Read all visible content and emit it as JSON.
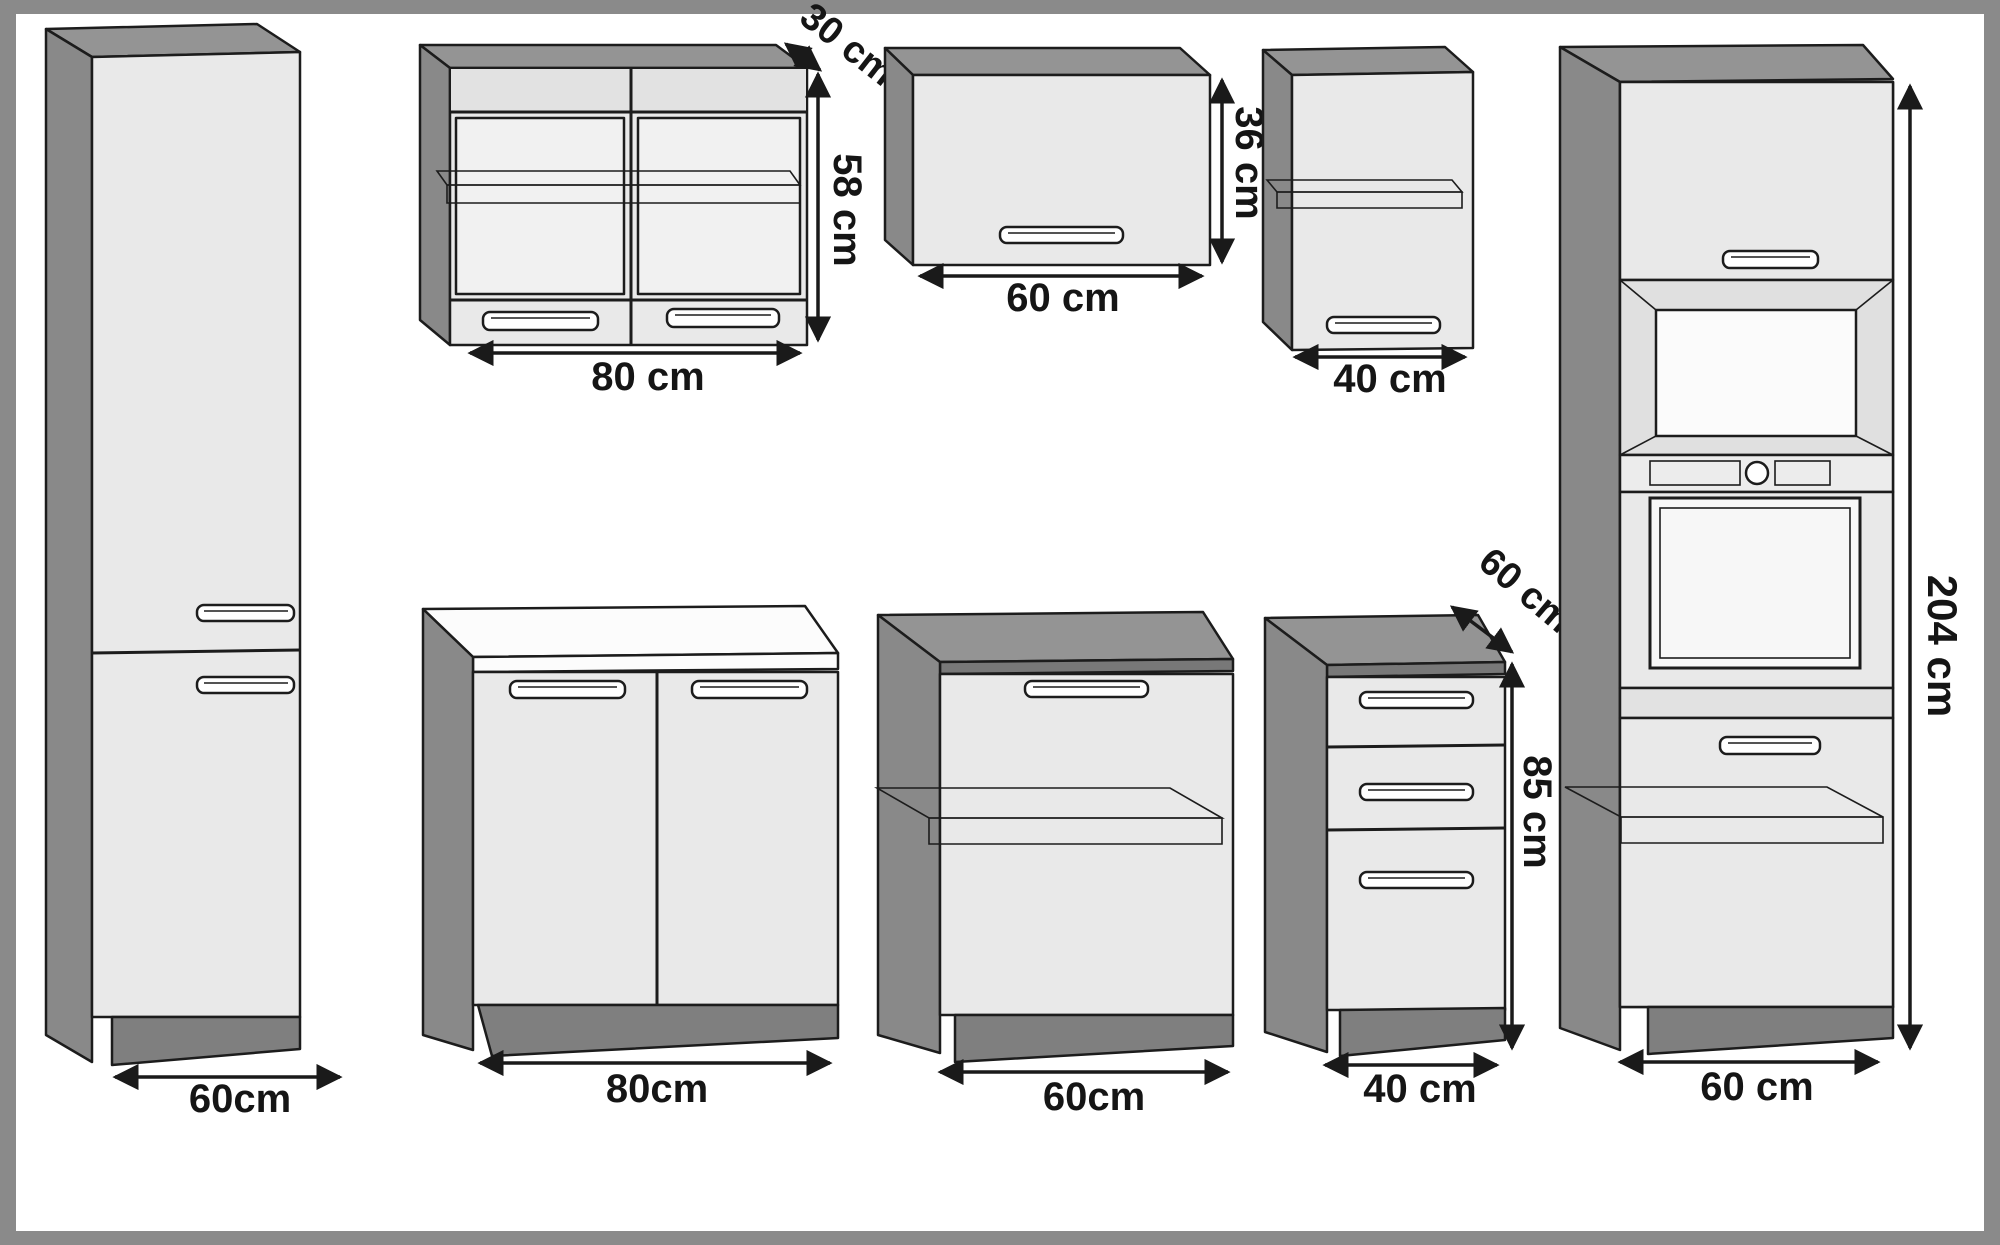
{
  "diagram": {
    "name": "Kitchen cabinet set dimension diagram",
    "units": "cm"
  },
  "colors": {
    "frame_border": "#8a8a8a",
    "background": "#ffffff",
    "panel_side": "#898989",
    "panel_top": "#949494",
    "front_face": "#e9e9e9",
    "glass": "#f1f1f1",
    "worktop_white": "#fcfcfc",
    "plinth": "#7f7f7f",
    "outline": "#1c1c1c",
    "label_text": "#151515"
  },
  "cabinets": {
    "tall_left": {
      "desc": "tall cabinet with two doors",
      "width": "60cm"
    },
    "wall_80": {
      "desc": "wall cabinet, two glass doors, one shelf",
      "width": "80 cm",
      "height": "58 cm",
      "depth": "30 cm"
    },
    "wall_60": {
      "desc": "wall lift-flap cabinet",
      "width": "60 cm",
      "height": "36 cm"
    },
    "wall_40": {
      "desc": "wall cabinet, one door, one shelf",
      "width": "40 cm"
    },
    "base_80": {
      "desc": "base cabinet, two doors, worktop",
      "width": "80cm"
    },
    "base_60": {
      "desc": "base cabinet, one door, one shelf",
      "width": "60cm"
    },
    "base_40": {
      "desc": "base cabinet with three drawers",
      "width": "40 cm",
      "height": "85 cm",
      "depth": "60 cm"
    },
    "tall_right": {
      "desc": "tall oven housing cabinet",
      "width": "60 cm",
      "height": "204 cm"
    }
  }
}
